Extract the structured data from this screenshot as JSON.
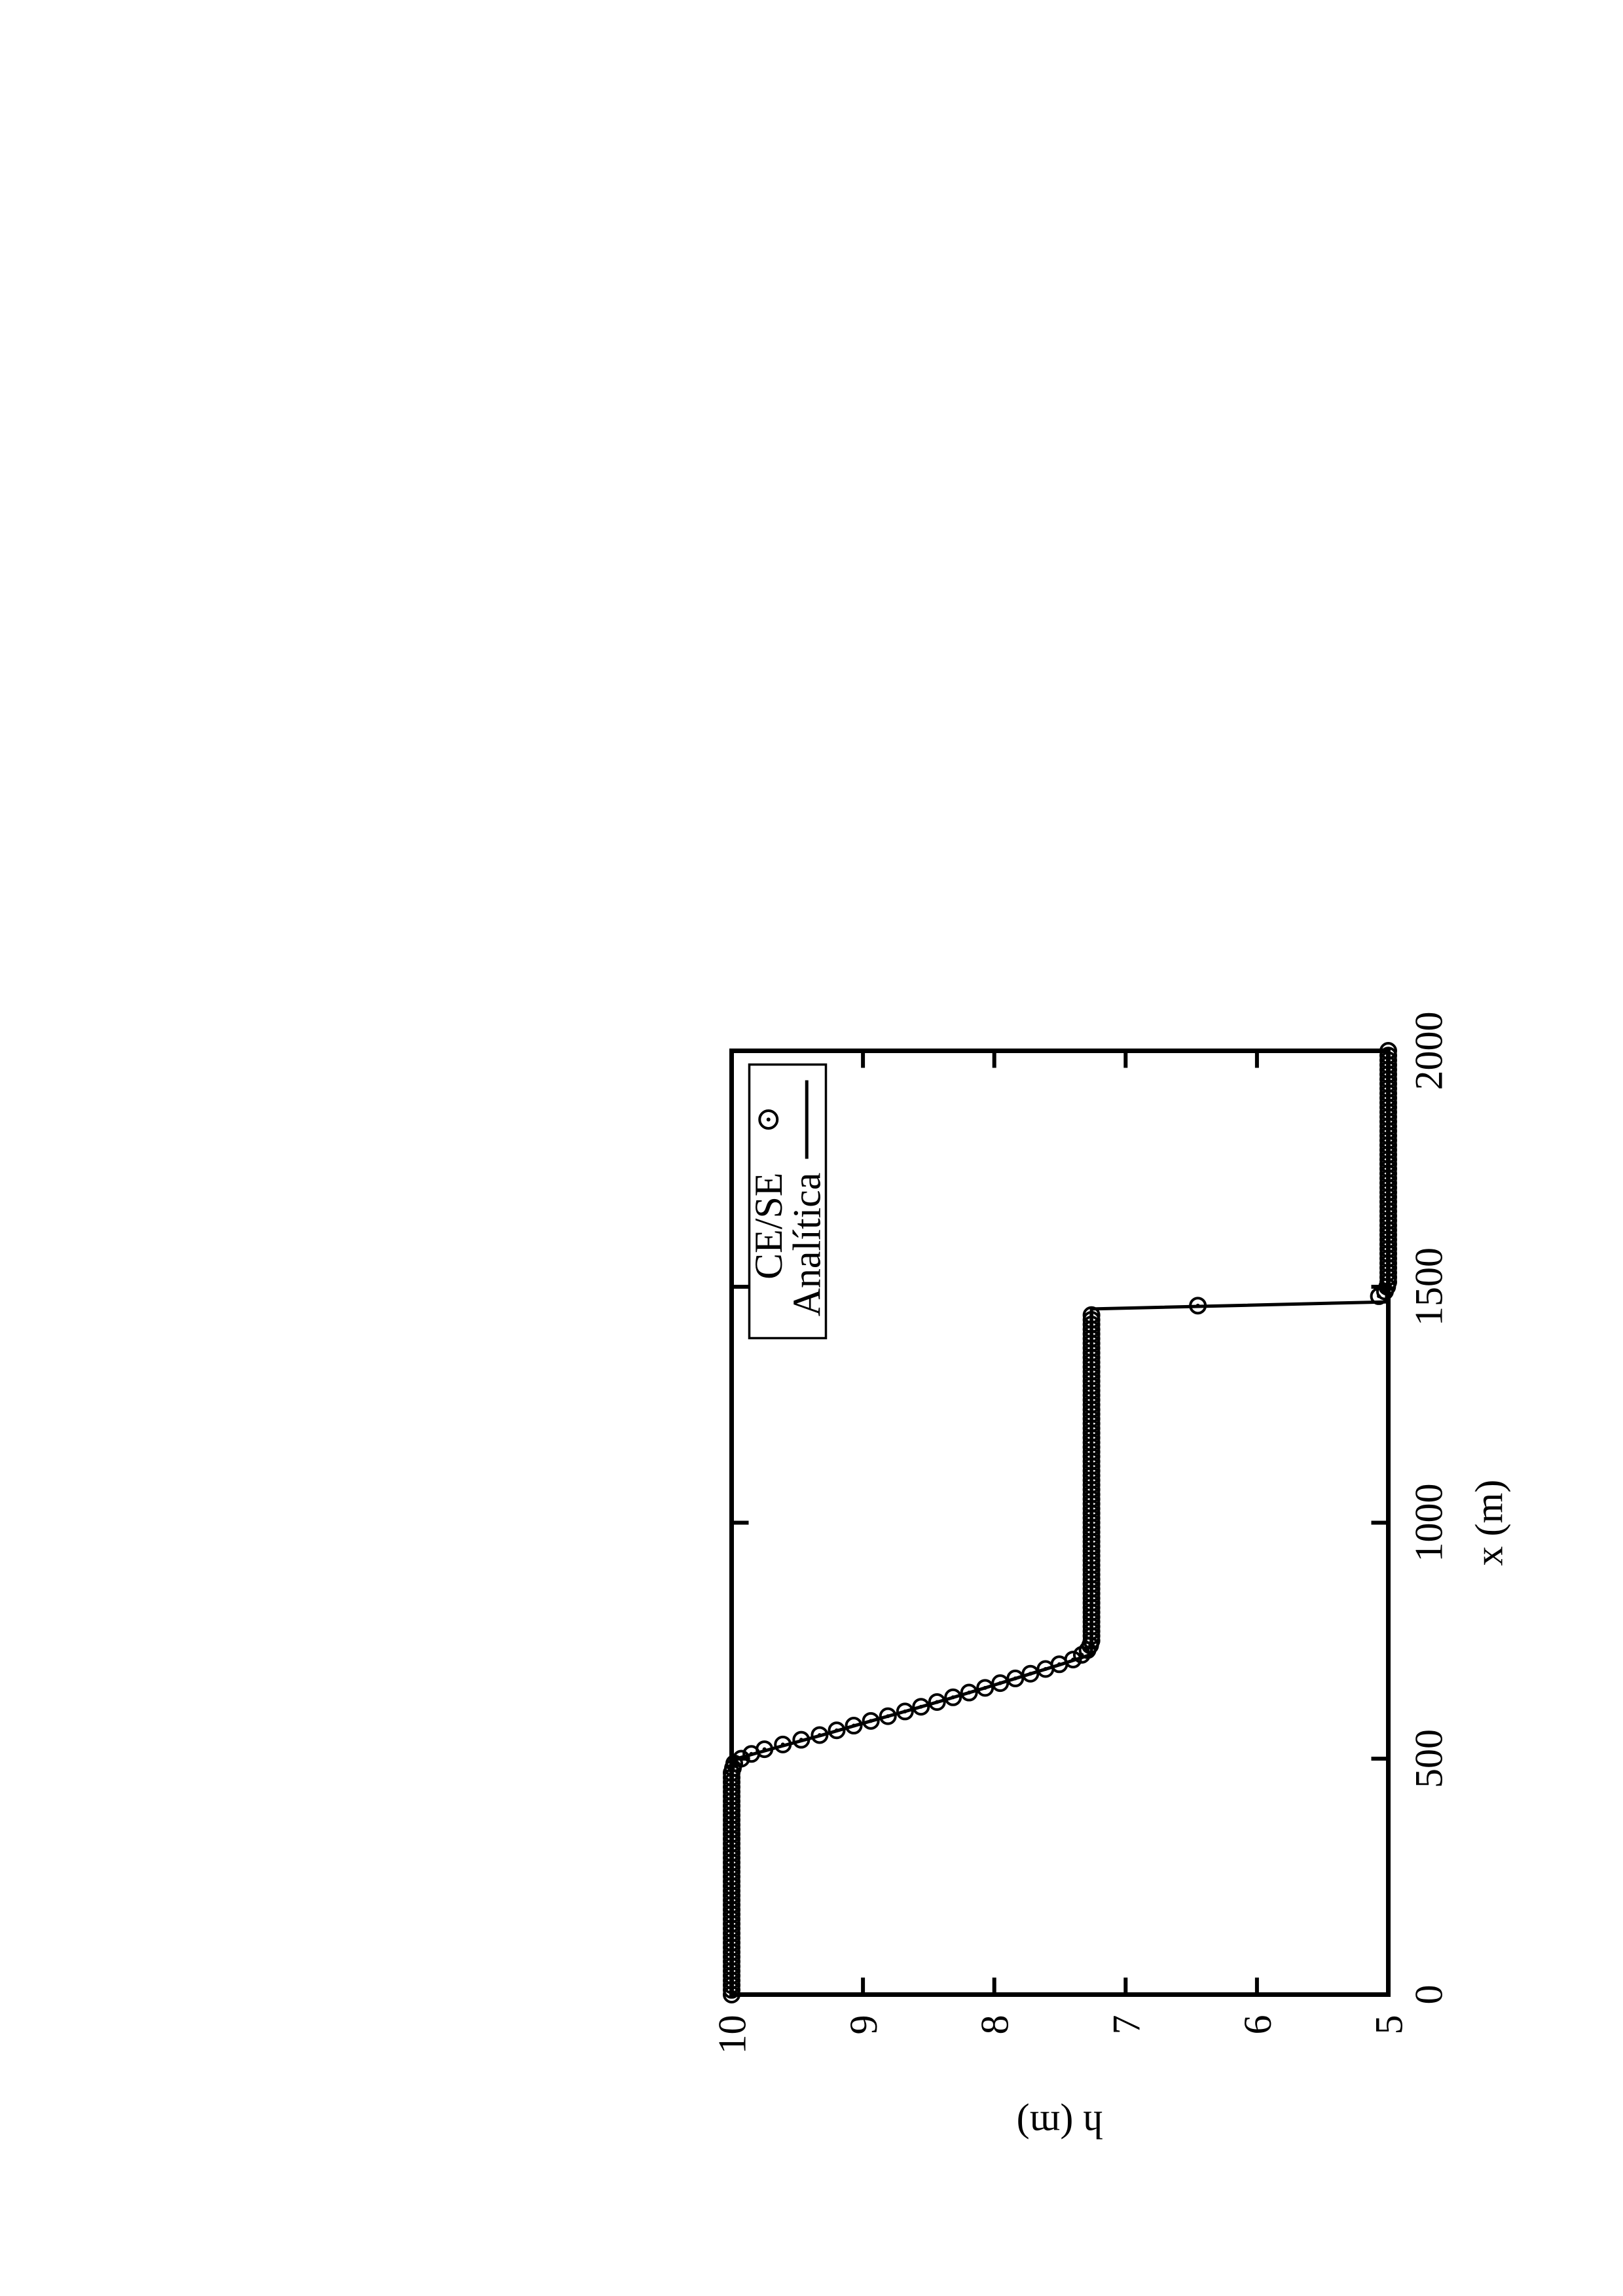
{
  "page": {
    "background": "#ffffff",
    "foreground": "#000000"
  },
  "chart_data": {
    "type": "line",
    "title": "",
    "xlabel": "x (m)",
    "ylabel": "h (m)",
    "xlim": [
      0,
      2000
    ],
    "ylim": [
      5,
      10
    ],
    "x_ticks": [
      0,
      500,
      1000,
      1500,
      2000
    ],
    "y_ticks": [
      5,
      6,
      7,
      8,
      9,
      10
    ],
    "grid": false,
    "legend": {
      "position": "top-right",
      "entries": [
        {
          "label": "CE/SE",
          "marker": "open-circle-dot"
        },
        {
          "label": "Analítica",
          "marker": "solid-line"
        }
      ]
    },
    "series": [
      {
        "name": "CE/SE",
        "type": "points",
        "sample_dx": 10,
        "profile_points": [
          [
            0,
            10
          ],
          [
            470,
            10
          ],
          [
            490,
            9.98
          ],
          [
            505,
            9.9
          ],
          [
            520,
            9.75
          ],
          [
            550,
            9.33
          ],
          [
            600,
            8.68
          ],
          [
            650,
            8.07
          ],
          [
            690,
            7.61
          ],
          [
            710,
            7.4
          ],
          [
            725,
            7.3
          ],
          [
            745,
            7.26
          ],
          [
            1448,
            7.26
          ],
          [
            1472,
            5.12
          ],
          [
            1487,
            5.03
          ],
          [
            1505,
            5.0
          ],
          [
            2000,
            5.0
          ]
        ],
        "shock_gap": [
          1448,
          1472
        ],
        "extra_points": [
          [
            1460,
            6.45
          ]
        ]
      },
      {
        "name": "Analítica",
        "type": "line",
        "points": [
          [
            0,
            10
          ],
          [
            497,
            10
          ],
          [
            525,
            9.64
          ],
          [
            550,
            9.31
          ],
          [
            575,
            9.0
          ],
          [
            600,
            8.68
          ],
          [
            625,
            8.37
          ],
          [
            650,
            8.07
          ],
          [
            675,
            7.78
          ],
          [
            700,
            7.49
          ],
          [
            721,
            7.26
          ],
          [
            1453,
            7.26
          ],
          [
            1468,
            5.0
          ],
          [
            2000,
            5.0
          ]
        ]
      }
    ],
    "colors": {
      "line": "#000000",
      "points": "#000000",
      "background": "#ffffff"
    },
    "description": "Dam-break depth profile: h=10 m upstream, rarefaction between x≈497 m and x≈721 m, intermediate plateau h≈7.26 m, shock at x≈1460 m (one numerical point at h≈6.45), h=5 m downstream. Page is a landscape plot rotated 90° CCW onto a portrait page."
  }
}
